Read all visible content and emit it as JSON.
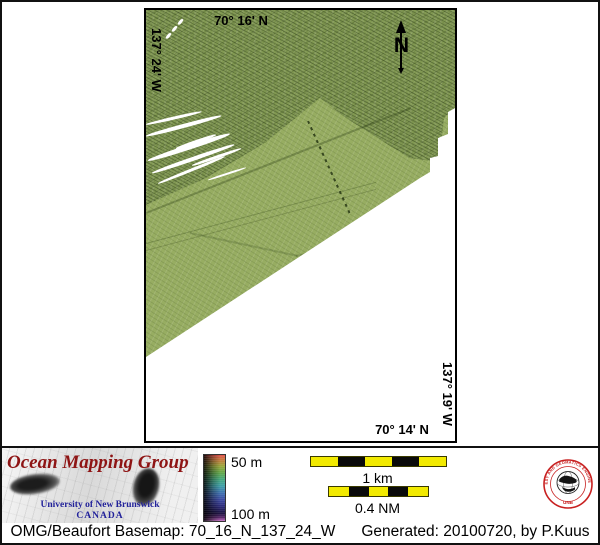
{
  "map": {
    "top_lat": "70° 16' N",
    "left_lon": "137° 24' W",
    "right_lon": "137° 19' W",
    "bottom_lat": "70° 14' N",
    "north_label": "N"
  },
  "legend": {
    "logo_title": "Ocean Mapping Group",
    "logo_subtitle": "University of New Brunswick",
    "logo_country": "CANADA",
    "colorbar_top": "50 m",
    "colorbar_bottom": "100 m",
    "scalebar_km": "1 km",
    "scalebar_nm": "0.4 NM",
    "seal_ring_text": "GEODESY AND GEOMATICS ENGINEERING",
    "seal_unb": "UNB"
  },
  "footer": {
    "left": "OMG/Beaufort Basemap: 70_16_N_137_24_W",
    "right": "Generated: 20100720, by P.Kuus"
  },
  "colors": {
    "swath_green": "#97ad62",
    "scalebar_yellow": "#f2ea00",
    "logo_red": "#8e1414",
    "logo_navy": "#22229a",
    "seal_red": "#c82020"
  }
}
